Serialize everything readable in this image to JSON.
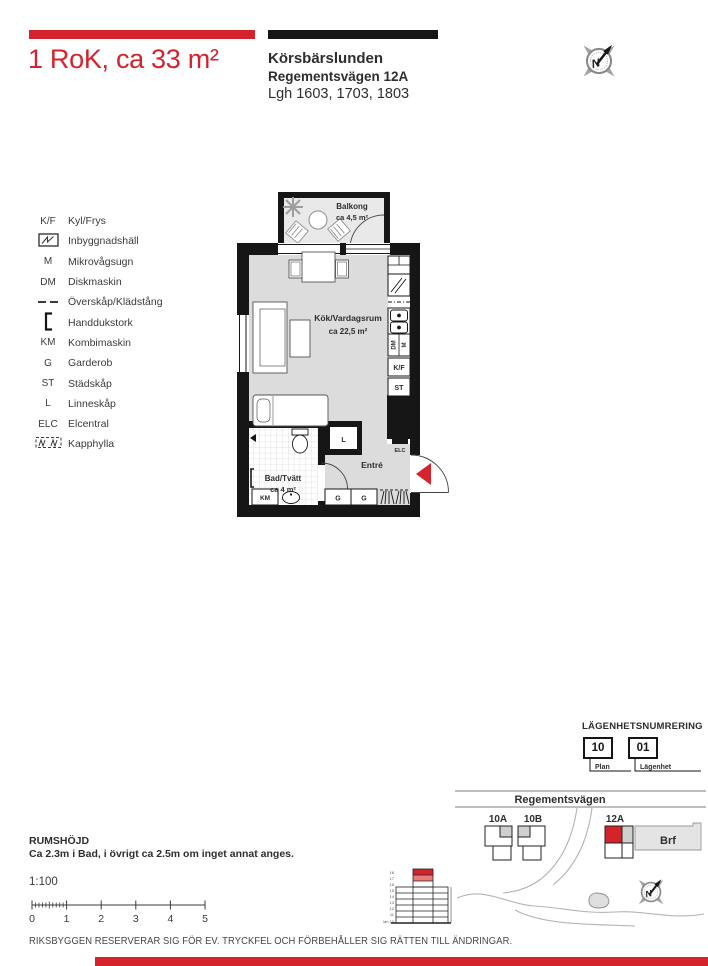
{
  "colors": {
    "red": "#d5232b",
    "black": "#161616",
    "floor_gray": "#dcdcdc",
    "balcony_gray": "#e9e9e9"
  },
  "header": {
    "title": "1 RoK, ca 33 m²",
    "project": "Körsbärslunden",
    "address": "Regementsvägen 12A",
    "apartments": "Lgh 1603, 1703, 1803"
  },
  "compass": {
    "n": "N"
  },
  "legend": {
    "items": [
      {
        "sym": "K/F",
        "label": "Kyl/Frys"
      },
      {
        "sym": "",
        "label": "Inbyggnadshäll"
      },
      {
        "sym": "M",
        "label": "Mikrovågsugn"
      },
      {
        "sym": "DM",
        "label": "Diskmaskin"
      },
      {
        "sym": "",
        "label": "Överskåp/Klädstång"
      },
      {
        "sym": "",
        "label": "Handdukstork"
      },
      {
        "sym": "KM",
        "label": "Kombimaskin"
      },
      {
        "sym": "G",
        "label": "Garderob"
      },
      {
        "sym": "ST",
        "label": "Städskåp"
      },
      {
        "sym": "L",
        "label": "Linneskåp"
      },
      {
        "sym": "ELC",
        "label": "Elcentral"
      },
      {
        "sym": "",
        "label": "Kapphylla"
      }
    ]
  },
  "plan": {
    "balcony": {
      "name": "Balkong",
      "area": "ca 4,5 m²"
    },
    "living": {
      "name": "Kök/Vardagsrum",
      "area": "ca 22,5 m²"
    },
    "bath": {
      "name": "Bad/Tvätt",
      "area": "ca 4 m²"
    },
    "entry": {
      "name": "Entré"
    },
    "cab": {
      "kf": "K/F",
      "st": "ST",
      "dm": "DM",
      "m": "M",
      "km": "KM",
      "l": "L",
      "elc": "ELC",
      "g": "G"
    }
  },
  "numbering": {
    "title": "LÄGENHETSNUMRERING",
    "plan_value": "10",
    "apt_value": "01",
    "plan_label": "Plan",
    "apt_label": "Lägenhet"
  },
  "map": {
    "street": "Regementsvägen",
    "b1": "10A",
    "b2": "10B",
    "b3": "12A",
    "brf": "Brf"
  },
  "elevation": {
    "floors": [
      "18",
      "17",
      "16",
      "15",
      "14",
      "13",
      "12",
      "11",
      "Plan 10"
    ]
  },
  "info": {
    "room_height_title": "RUMSHÖJD",
    "room_height_text": "Ca 2.3m i Bad, i övrigt ca 2.5m om inget annat anges.",
    "scale": "1:100",
    "scale_ticks": [
      "0",
      "1",
      "2",
      "3",
      "4",
      "5"
    ]
  },
  "footer": {
    "disclaimer": "RIKSBYGGEN RESERVERAR SIG FÖR EV. TRYCKFEL OCH FÖRBEHÅLLER SIG RÄTTEN TILL ÄNDRINGAR."
  }
}
